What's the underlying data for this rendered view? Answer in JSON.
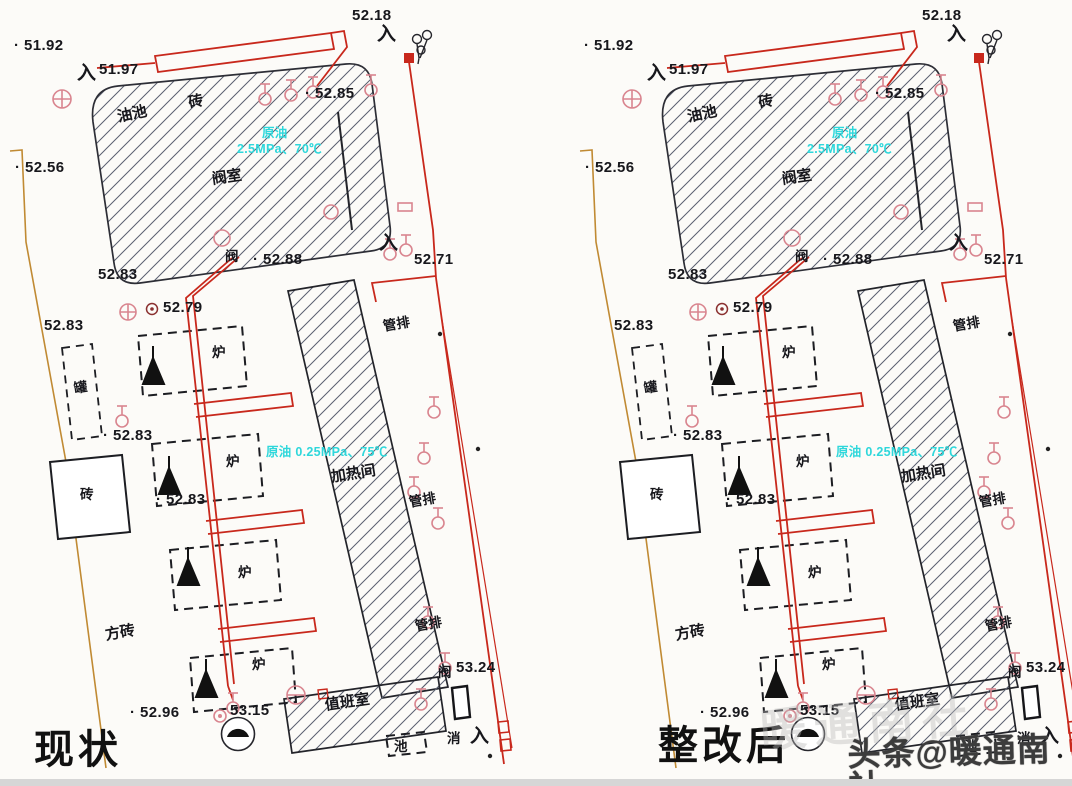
{
  "drawings": [
    {
      "dx": 0,
      "caption": "现状"
    },
    {
      "dx": 570,
      "caption": "整改后"
    }
  ],
  "watermark": {
    "text": "头条@暖通南社",
    "ghost": "暖通南社"
  },
  "plan": {
    "rooms": {
      "valve_room": "阀室",
      "heating_room": "加热间",
      "duty_room": "值班室",
      "oil_pool": "油池",
      "tank": "罐",
      "furnace": "炉",
      "brick": "砖",
      "square_brick": "方砖",
      "pipe_rack": "管排",
      "pool": "池",
      "hydrant": "消",
      "valve": "阀",
      "entrance": "入"
    },
    "annotations": {
      "valve_room_medium": "原油 2.5MPa、70℃",
      "heating_room_medium": "原油 0.25MPa、75℃"
    },
    "colors": {
      "pipe_red": "#c8281c",
      "valve_pink": "#d9858f",
      "boundary_orange": "#c08a33",
      "annotation_cyan": "#2ed7db",
      "line_black": "#23242a"
    },
    "labels": [
      {
        "t": "· 51.92",
        "x": 14,
        "y": 38,
        "c": "elev"
      },
      {
        "t": "入",
        "x": 77,
        "y": 64,
        "c": "entry"
      },
      {
        "t": "51.97",
        "x": 99,
        "y": 62,
        "c": "elev"
      },
      {
        "t": "52.18",
        "x": 352,
        "y": 8,
        "c": "elev"
      },
      {
        "t": "入",
        "x": 377,
        "y": 25,
        "c": "entry"
      },
      {
        "t": "· 52.85",
        "x": 305,
        "y": 86,
        "c": "elev"
      },
      {
        "t": "油池",
        "x": 116,
        "y": 110,
        "c": "zh",
        "r": -12
      },
      {
        "t": "砖",
        "x": 187,
        "y": 96,
        "c": "zh",
        "r": -12
      },
      {
        "t": "原油",
        "x": 262,
        "y": 127,
        "c": "cyan"
      },
      {
        "t": "2.5MPa、70℃",
        "x": 237,
        "y": 143,
        "c": "cyan"
      },
      {
        "t": "阀室",
        "x": 211,
        "y": 172,
        "c": "zh",
        "r": -8
      },
      {
        "t": "· 52.56",
        "x": 15,
        "y": 160,
        "c": "elev"
      },
      {
        "t": "阀",
        "x": 225,
        "y": 250,
        "c": "zh-sm"
      },
      {
        "t": "· 52.88",
        "x": 253,
        "y": 252,
        "c": "elev"
      },
      {
        "t": "52.83",
        "x": 98,
        "y": 267,
        "c": "elev"
      },
      {
        "t": "入",
        "x": 379,
        "y": 234,
        "c": "entry"
      },
      {
        "t": "52.71",
        "x": 414,
        "y": 252,
        "c": "elev"
      },
      {
        "t": "管排",
        "x": 382,
        "y": 320,
        "c": "zh-sm",
        "r": -10
      },
      {
        "t": "52.79",
        "x": 163,
        "y": 300,
        "c": "elev"
      },
      {
        "t": "52.83",
        "x": 44,
        "y": 318,
        "c": "elev"
      },
      {
        "t": "罐",
        "x": 73,
        "y": 382,
        "c": "zh-sm",
        "r": -8
      },
      {
        "t": "炉",
        "x": 212,
        "y": 346,
        "c": "zh-sm"
      },
      {
        "t": "· 52.83",
        "x": 103,
        "y": 428,
        "c": "elev"
      },
      {
        "t": "原油 0.25MPa、75℃",
        "x": 266,
        "y": 446,
        "c": "cyan"
      },
      {
        "t": "炉",
        "x": 226,
        "y": 455,
        "c": "zh-sm"
      },
      {
        "t": "加热间",
        "x": 330,
        "y": 470,
        "c": "zh",
        "r": -9
      },
      {
        "t": "管排",
        "x": 408,
        "y": 496,
        "c": "zh-sm",
        "r": -10
      },
      {
        "t": "· 52.83",
        "x": 156,
        "y": 492,
        "c": "elev"
      },
      {
        "t": "砖",
        "x": 80,
        "y": 488,
        "c": "zh-sm"
      },
      {
        "t": "方砖",
        "x": 104,
        "y": 628,
        "c": "zh",
        "r": -10
      },
      {
        "t": "炉",
        "x": 238,
        "y": 566,
        "c": "zh-sm"
      },
      {
        "t": "管排",
        "x": 414,
        "y": 620,
        "c": "zh-sm",
        "r": -10
      },
      {
        "t": "炉",
        "x": 252,
        "y": 658,
        "c": "zh-sm"
      },
      {
        "t": "阀",
        "x": 438,
        "y": 666,
        "c": "zh-sm"
      },
      {
        "t": "53.24",
        "x": 456,
        "y": 660,
        "c": "elev"
      },
      {
        "t": "值班室",
        "x": 324,
        "y": 698,
        "c": "zh",
        "r": -8
      },
      {
        "t": "· 52.96",
        "x": 130,
        "y": 705,
        "c": "elev"
      },
      {
        "t": "53.15",
        "x": 230,
        "y": 703,
        "c": "elev"
      },
      {
        "t": "池",
        "x": 394,
        "y": 740,
        "c": "zh-sm"
      },
      {
        "t": "消",
        "x": 447,
        "y": 732,
        "c": "zh-sm"
      },
      {
        "t": "入",
        "x": 470,
        "y": 727,
        "c": "entry"
      }
    ]
  }
}
